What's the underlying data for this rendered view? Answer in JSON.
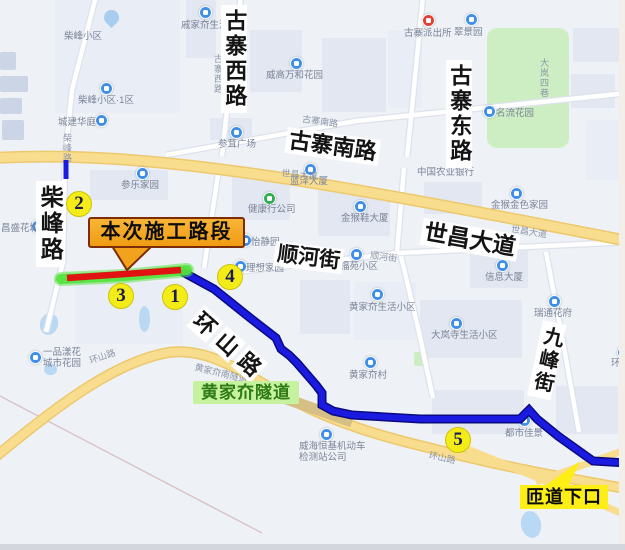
{
  "map": {
    "annotations": {
      "construction": {
        "label": "本次施工路段"
      },
      "tunnel": {
        "label": "黄家夼隧道"
      },
      "ramp": {
        "label": "匝道下口"
      },
      "markers": [
        {
          "n": "1",
          "x": 175,
          "y": 297
        },
        {
          "n": "2",
          "x": 79,
          "y": 204
        },
        {
          "n": "3",
          "x": 121,
          "y": 296
        },
        {
          "n": "4",
          "x": 230,
          "y": 277
        },
        {
          "n": "5",
          "x": 458,
          "y": 440
        }
      ]
    },
    "colors": {
      "route_blue": "#1a1ae0",
      "route_blue_edge": "#0a0a80",
      "construction_red": "#e01212",
      "glow_green": "#52e23c",
      "marker_yellow": "#f4ec16",
      "callout_bg": "#f2a21c",
      "tunnel_bg": "#c6f2a0",
      "ramp_bg": "#fdee15",
      "main_road_yellow": "#f9dd8f"
    },
    "big_road_labels": [
      {
        "text": "古寨西路",
        "x": 221,
        "y": 5,
        "vert": true,
        "size": 22
      },
      {
        "text": "古寨东路",
        "x": 446,
        "y": 60,
        "vert": true,
        "size": 22
      },
      {
        "text": "古寨南路",
        "x": 288,
        "y": 127,
        "rot": 8,
        "size": 22
      },
      {
        "text": "柴峰路",
        "x": 36,
        "y": 181,
        "vert": true,
        "size": 23
      },
      {
        "text": "世昌大道",
        "x": 424,
        "y": 218,
        "rot": 10,
        "size": 23
      },
      {
        "text": "顺河街",
        "x": 276,
        "y": 241,
        "rot": 7,
        "size": 21
      },
      {
        "text": "环山路",
        "x": 203,
        "y": 307,
        "rot": 42,
        "size": 22,
        "gap": true
      },
      {
        "text": "九峰街",
        "x": 543,
        "y": 320,
        "vert": true,
        "rot": 12,
        "size": 20
      }
    ],
    "small_road_labels": [
      {
        "text": "柴峰路",
        "x": 62,
        "y": 133,
        "vert": true
      },
      {
        "text": "古寨西路",
        "x": 213,
        "y": 54,
        "vert": true
      },
      {
        "text": "大岚四巷",
        "x": 539,
        "y": 58,
        "vert": true
      },
      {
        "text": "古寨南路",
        "x": 303,
        "y": 114,
        "rot": 8
      },
      {
        "text": "世昌大道",
        "x": 282,
        "y": 168,
        "rot": 5
      },
      {
        "text": "世昌大道",
        "x": 512,
        "y": 224,
        "rot": 9
      },
      {
        "text": "顺河街",
        "x": 371,
        "y": 250,
        "rot": 8
      },
      {
        "text": "环山路",
        "x": 88,
        "y": 356,
        "rot": -18
      },
      {
        "text": "黄家夼南隧道",
        "x": 196,
        "y": 362,
        "rot": 14
      },
      {
        "text": "环山路",
        "x": 430,
        "y": 450,
        "rot": 12
      }
    ],
    "pois": [
      {
        "text": "戚家夼生活小区",
        "x": 181,
        "y": 20,
        "icon": "blue",
        "ix": 199,
        "iy": 6
      },
      {
        "text": "柴峰小区",
        "x": 64,
        "y": 31
      },
      {
        "text": "柴峰小区·1区",
        "x": 78,
        "y": 95,
        "icon": "blue",
        "ix": 100,
        "iy": 82
      },
      {
        "text": "城建华庭",
        "x": 58,
        "y": 117,
        "icon": "blue",
        "ix": 95,
        "iy": 114
      },
      {
        "text": "威高万和花园",
        "x": 266,
        "y": 70,
        "icon": "blue",
        "ix": 290,
        "iy": 57
      },
      {
        "text": "古寨派出所",
        "x": 404,
        "y": 28,
        "icon": "red",
        "ix": 422,
        "iy": 14
      },
      {
        "text": "翠景园",
        "x": 454,
        "y": 27,
        "icon": "blue",
        "ix": 465,
        "iy": 13
      },
      {
        "text": "名流花园",
        "x": 496,
        "y": 108,
        "icon": "blue",
        "ix": 483,
        "iy": 105
      },
      {
        "text": "参茸广场",
        "x": 218,
        "y": 139,
        "icon": "blue",
        "ix": 230,
        "iy": 126
      },
      {
        "text": "参乐家园",
        "x": 121,
        "y": 180,
        "icon": "blue",
        "ix": 136,
        "iy": 167
      },
      {
        "text": "蓝泽大厦",
        "x": 290,
        "y": 176,
        "icon": "blue",
        "ix": 304,
        "iy": 163
      },
      {
        "text": "健康行公司",
        "x": 248,
        "y": 204,
        "icon": "green",
        "ix": 263,
        "iy": 192
      },
      {
        "text": "金猴鞋大厦",
        "x": 341,
        "y": 213,
        "icon": "blue",
        "ix": 354,
        "iy": 200
      },
      {
        "text": "中国农业银行",
        "x": 417,
        "y": 167
      },
      {
        "text": "金猴金色家园",
        "x": 491,
        "y": 200,
        "icon": "blue",
        "ix": 510,
        "iy": 187
      },
      {
        "text": "怡静园",
        "x": 251,
        "y": 237,
        "icon": "blue",
        "ix": 239,
        "iy": 234
      },
      {
        "text": "理想家园",
        "x": 246,
        "y": 263,
        "icon": "blue",
        "ix": 234,
        "iy": 260
      },
      {
        "text": "福苑小区",
        "x": 340,
        "y": 261,
        "icon": "blue",
        "ix": 350,
        "iy": 248
      },
      {
        "text": "信息大厦",
        "x": 485,
        "y": 272,
        "icon": "blue",
        "ix": 496,
        "iy": 259
      },
      {
        "text": "瑞通花府",
        "x": 534,
        "y": 308,
        "icon": "blue",
        "ix": 548,
        "iy": 295
      },
      {
        "text": "黄家夼生活小区",
        "x": 349,
        "y": 302,
        "icon": "blue",
        "ix": 371,
        "iy": 288
      },
      {
        "text": "大岚寺生活小区",
        "x": 431,
        "y": 330,
        "icon": "blue",
        "ix": 450,
        "iy": 317
      },
      {
        "text": "环翠园",
        "x": 611,
        "y": 358,
        "icon": "blue",
        "ix": 617,
        "iy": 346
      },
      {
        "text": "黄家夼村",
        "x": 349,
        "y": 370,
        "icon": "blue",
        "ix": 364,
        "iy": 356
      },
      {
        "text": "都市佳景",
        "x": 505,
        "y": 428,
        "icon": "blue",
        "ix": 518,
        "iy": 414
      },
      {
        "text": "威海恒基机动车\n检测站公司",
        "x": 299,
        "y": 441,
        "icon": "blue",
        "ix": 320,
        "iy": 428
      },
      {
        "text": "一品漾花\n城市花园",
        "x": 43,
        "y": 347,
        "icon": "blue",
        "ix": 29,
        "iy": 351
      },
      {
        "text": "昌盛花城",
        "x": 1,
        "y": 223,
        "icon": "blue",
        "ix": 31,
        "iy": 220
      }
    ]
  }
}
